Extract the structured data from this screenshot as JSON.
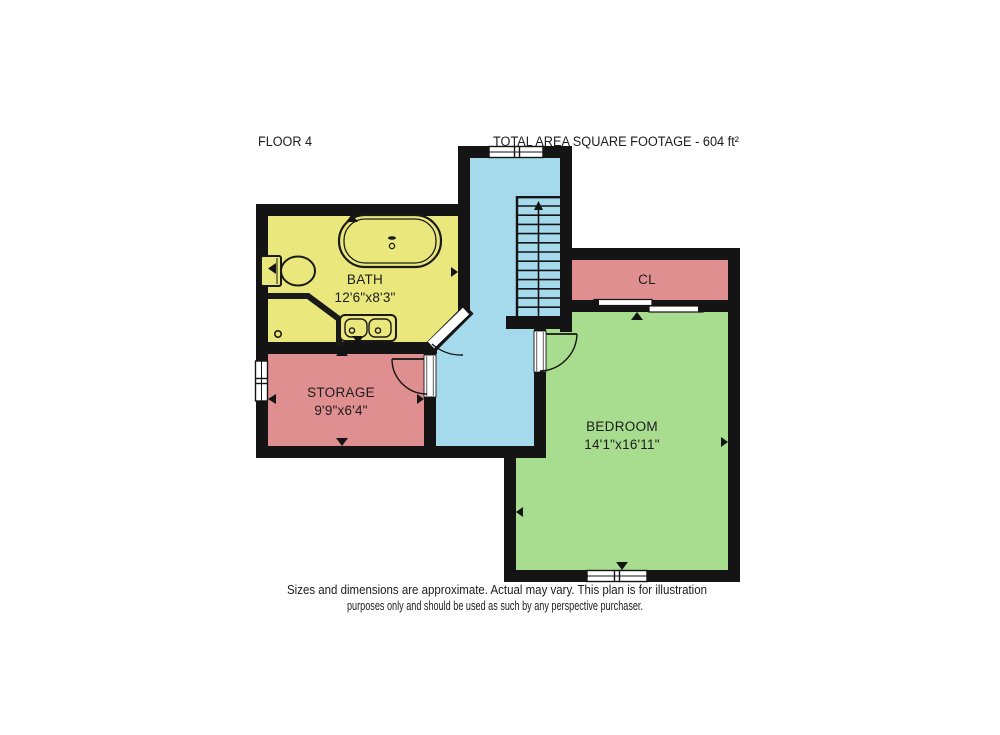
{
  "header": {
    "floor_label": "FLOOR 4",
    "total_area": "TOTAL AREA SQUARE FOOTAGE - 604 ft²"
  },
  "rooms": {
    "bath": {
      "name": "BATH",
      "dims": "12'6\"x8'3\""
    },
    "storage": {
      "name": "STORAGE",
      "dims": "9'9\"x6'4\""
    },
    "closet": {
      "name": "CL"
    },
    "bedroom": {
      "name": "BEDROOM",
      "dims": "14'1\"x16'11\""
    }
  },
  "footer": {
    "line1": "Sizes and dimensions are approximate. Actual may vary. This plan is for illustration",
    "line2": "purposes only and should be used as such by any perspective purchaser."
  },
  "colors": {
    "bath": "#eae87c",
    "storage": "#df8f8f",
    "closet": "#df8f8f",
    "bedroom": "#a8dc8f",
    "hall": "#a5d9ec",
    "wall": "#141414",
    "fixture_line": "#1a1a1a"
  },
  "icons": {
    "staircase_direction": "up-arrow"
  }
}
